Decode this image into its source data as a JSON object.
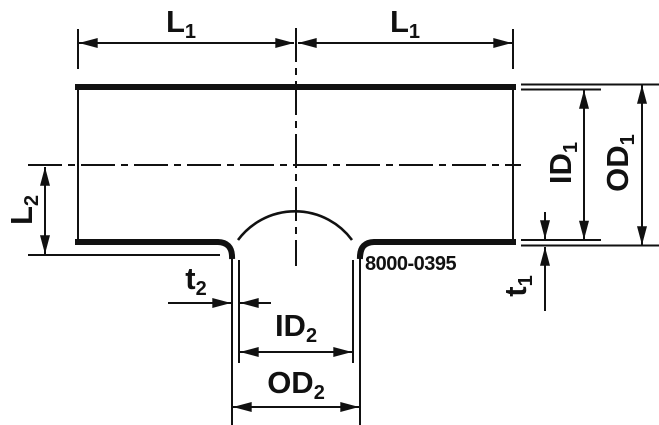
{
  "diagram": {
    "type": "technical-drawing",
    "subject": "reducing-tee-pipe-fitting-section",
    "part_number": "8000-0395",
    "labels": {
      "l1_left": {
        "main": "L",
        "sub": "1"
      },
      "l1_right": {
        "main": "L",
        "sub": "1"
      },
      "l2": {
        "main": "L",
        "sub": "2"
      },
      "id1": {
        "main": "ID",
        "sub": "1"
      },
      "od1": {
        "main": "OD",
        "sub": "1"
      },
      "t1": {
        "main": "t",
        "sub": "1"
      },
      "t2": {
        "main": "t",
        "sub": "2"
      },
      "id2": {
        "main": "ID",
        "sub": "2"
      },
      "od2": {
        "main": "OD",
        "sub": "2"
      }
    },
    "colors": {
      "line": "#111111",
      "background": "#ffffff"
    }
  }
}
